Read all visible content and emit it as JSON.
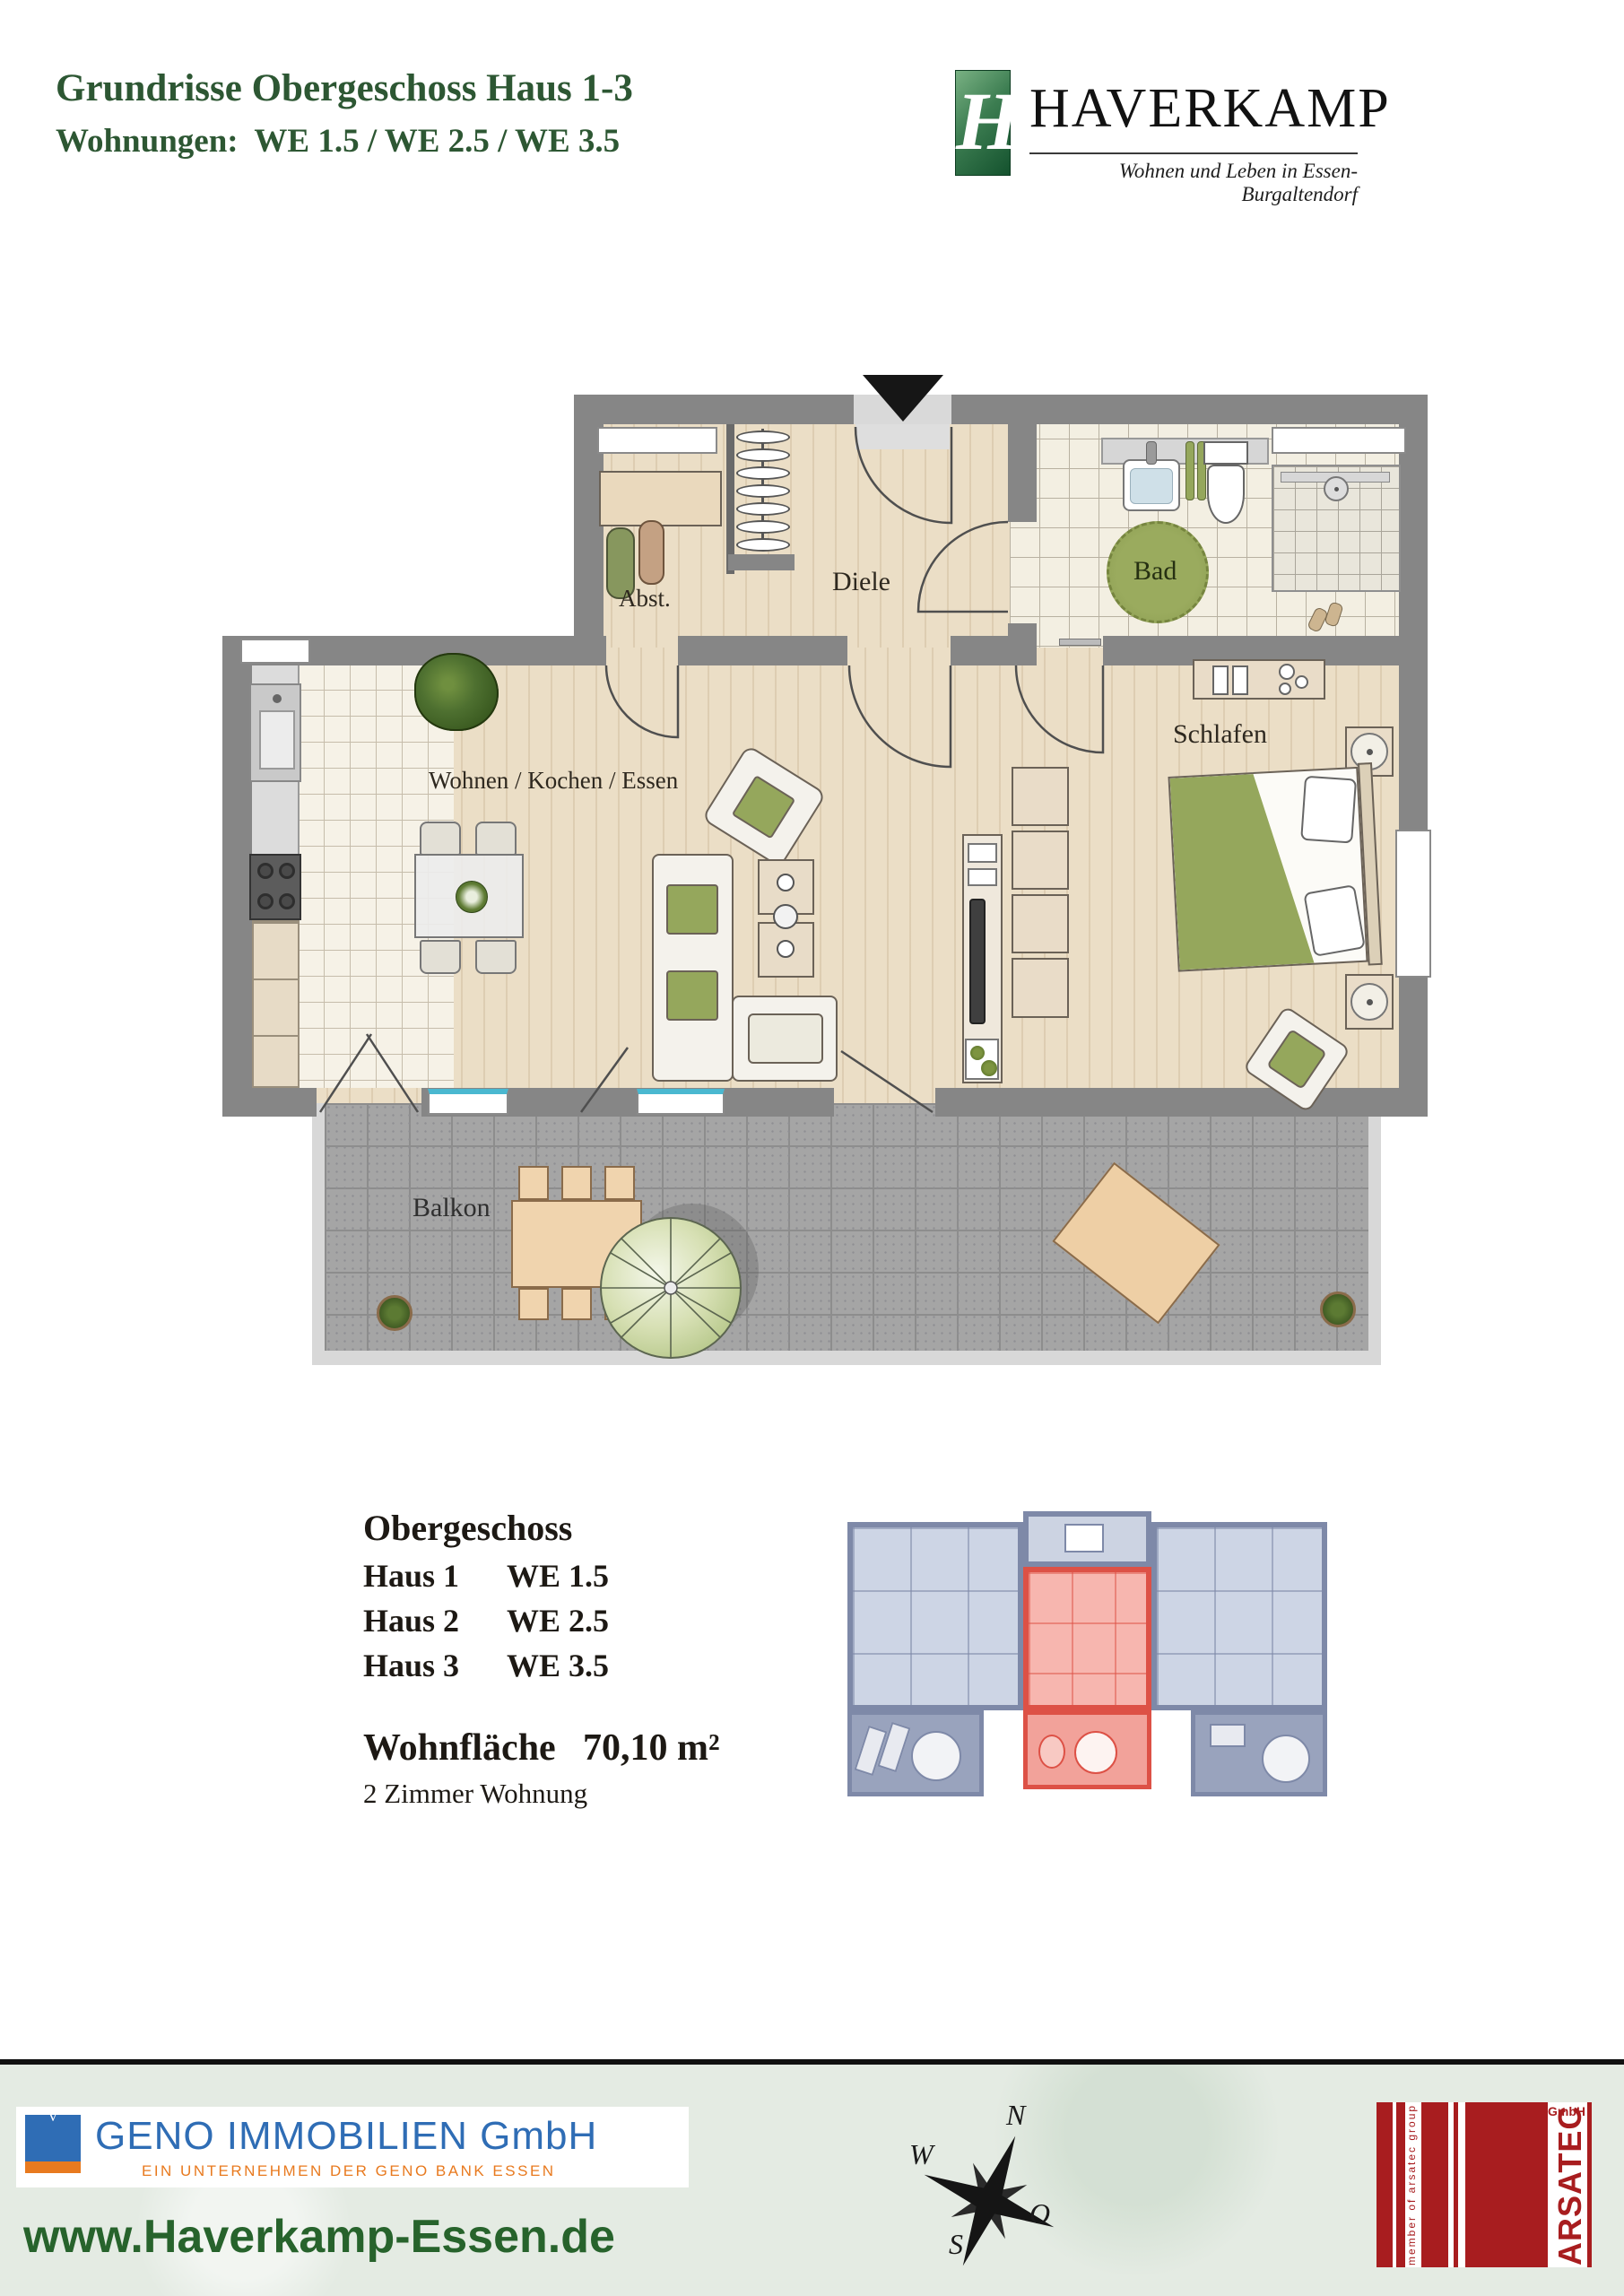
{
  "header": {
    "title": "Grundrisse Obergeschoss Haus 1-3",
    "subtitle": "Wohnungen:  WE 1.5 / WE 2.5 / WE 3.5",
    "brand": {
      "monogram": "H",
      "name": "HAVERKAMP",
      "tagline": "Wohnen und Leben in Essen-Burgaltendorf"
    }
  },
  "floorplan": {
    "rooms": [
      {
        "id": "abst",
        "label": "Abst."
      },
      {
        "id": "diele",
        "label": "Diele"
      },
      {
        "id": "bad",
        "label": "Bad"
      },
      {
        "id": "schlafen",
        "label": "Schlafen"
      },
      {
        "id": "wohnen",
        "label": "Wohnen / Kochen / Essen"
      },
      {
        "id": "balkon",
        "label": "Balkon"
      }
    ]
  },
  "details": {
    "floor_heading": "Obergeschoss",
    "units": [
      {
        "house": "Haus 1",
        "unit": "WE 1.5"
      },
      {
        "house": "Haus 2",
        "unit": "WE 2.5"
      },
      {
        "house": "Haus 3",
        "unit": "WE 3.5"
      }
    ],
    "area_label": "Wohnfläche",
    "area_value": "70,10 m²",
    "apartment_type": "2 Zimmer Wohnung"
  },
  "footer": {
    "geno": {
      "name": "GENO IMMOBILIEN GmbH",
      "tagline": "EIN UNTERNEHMEN DER GENO BANK ESSEN"
    },
    "website": "www.Haverkamp-Essen.de",
    "compass": {
      "n": "N",
      "w": "W",
      "o": "O",
      "s": "S"
    },
    "arsatec": {
      "name": "ARSATEC",
      "suffix": "GmbH",
      "member": "member of arsatec group"
    }
  },
  "colors": {
    "headgreen": "#2d5733",
    "logogreen": "#1d5c33",
    "wall": "#868686",
    "green": "#95a75c",
    "red": "#dd5146",
    "redfill": "#f7b6af",
    "blue": "#2f6db5",
    "orange": "#e87a1f",
    "arsred": "#a81d1f",
    "webgreen": "#27632c",
    "footerbg": "#e4ebe3",
    "cyan": "#4ab8d0"
  }
}
